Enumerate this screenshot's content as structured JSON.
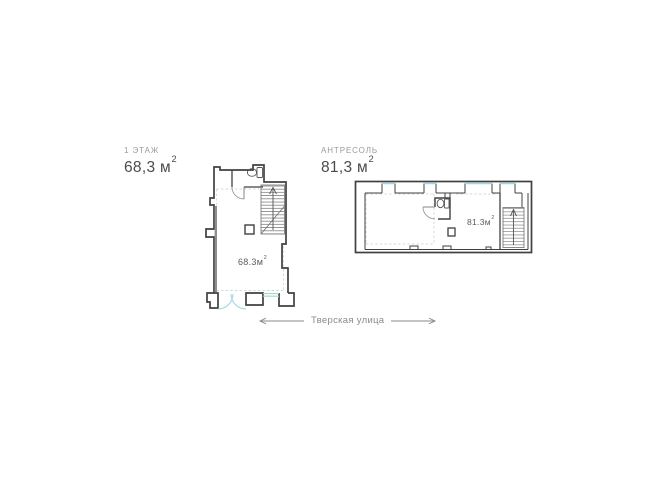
{
  "plans": [
    {
      "title": "1 ЭТАЖ",
      "area_value": "68,3 м",
      "area_sup": "2",
      "room_label": "68.3м",
      "room_sup": "2"
    },
    {
      "title": "АНТРЕСОЛЬ",
      "area_value": "81,3 м",
      "area_sup": "2",
      "room_label": "81.3м",
      "room_sup": "2"
    }
  ],
  "street": {
    "label": "Тверская улица"
  },
  "colors": {
    "wall": "#404040",
    "window_glass": "#9fd8e6",
    "entry_door_arc": "#aed7e6",
    "window_green": "#a3d9c9",
    "dashed_guide": "#ccdcd4",
    "title_text": "#4a4a4a",
    "subtitle_text": "#9b9b9b",
    "street_text": "#8a8a8a"
  }
}
